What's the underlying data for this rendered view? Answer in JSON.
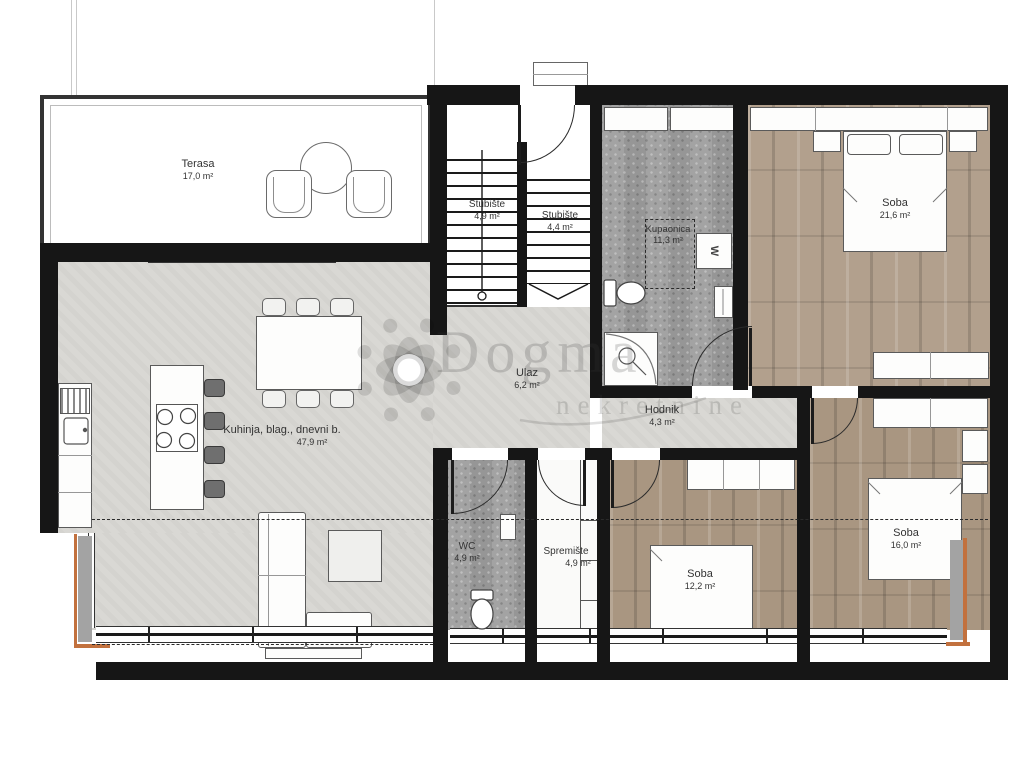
{
  "plan": {
    "watermark": {
      "brand": "Dogma",
      "sub": "nekretnine"
    },
    "rooms": {
      "terasa": {
        "name": "Terasa",
        "area": "17,0 m²"
      },
      "stubiste_1": {
        "name": "Stubište",
        "area": "4,9 m²"
      },
      "stubiste_2": {
        "name": "Stubište",
        "area": "4,4 m²"
      },
      "kupaonica": {
        "name": "Kupaonica",
        "area": "11,3 m²"
      },
      "soba_1": {
        "name": "Soba",
        "area": "21,6 m²"
      },
      "ulaz": {
        "name": "Ulaz",
        "area": "6,2 m²"
      },
      "hodnik": {
        "name": "Hodnik",
        "area": "4,3 m²"
      },
      "kuhinja": {
        "name": "Kuhinja, blag., dnevni b.",
        "area": "47,9 m²"
      },
      "wc": {
        "name": "WC",
        "area": "4,9 m²"
      },
      "spremiste": {
        "name": "Spremište",
        "area": "4,9 m²"
      },
      "soba_2": {
        "name": "Soba",
        "area": "12,2 m²"
      },
      "soba_3": {
        "name": "Soba",
        "area": "16,0 m²"
      }
    },
    "appliances": {
      "washer_label": "W"
    },
    "colors": {
      "wall": "#161616",
      "floor_gray": "#d9d8d4",
      "tile": "#9e9e9e",
      "wood": "#b2a08d",
      "accent_orange": "#c2713e"
    }
  }
}
